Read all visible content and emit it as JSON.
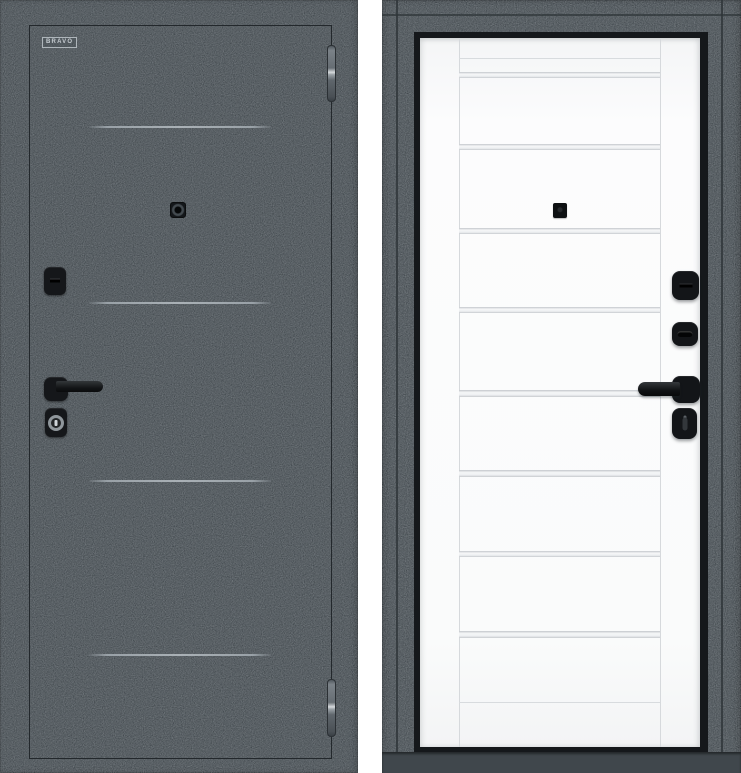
{
  "meta": {
    "content_type": "product photo",
    "subject": "steel entrance door shown from exterior and interior sides"
  },
  "brand": {
    "logo_text": "BRAVO"
  },
  "exterior_view": {
    "name": "exterior side, dark charcoal",
    "surface_color": "#3d4449",
    "decorative_line_count": 4,
    "hinge_count": 2,
    "hardware": [
      "deadbolt escutcheon",
      "lever handle",
      "cylinder lock",
      "peephole"
    ]
  },
  "interior_view": {
    "name": "interior side, white leaf in dark frame",
    "leaf_color": "#fafbfb",
    "frame_color": "#3e454a",
    "glass_strip_count": 8,
    "hardware": [
      "thumbturn escutcheon",
      "thumbturn escutcheon",
      "lever handle",
      "privacy turn",
      "peephole"
    ]
  },
  "palette": {
    "hardware_black": "#141618",
    "hinge_metal": "#aab1b6",
    "glass_strip": "#eef0f2",
    "seam_line": "#d6d9dc",
    "decor_line": "#a6adb2"
  }
}
